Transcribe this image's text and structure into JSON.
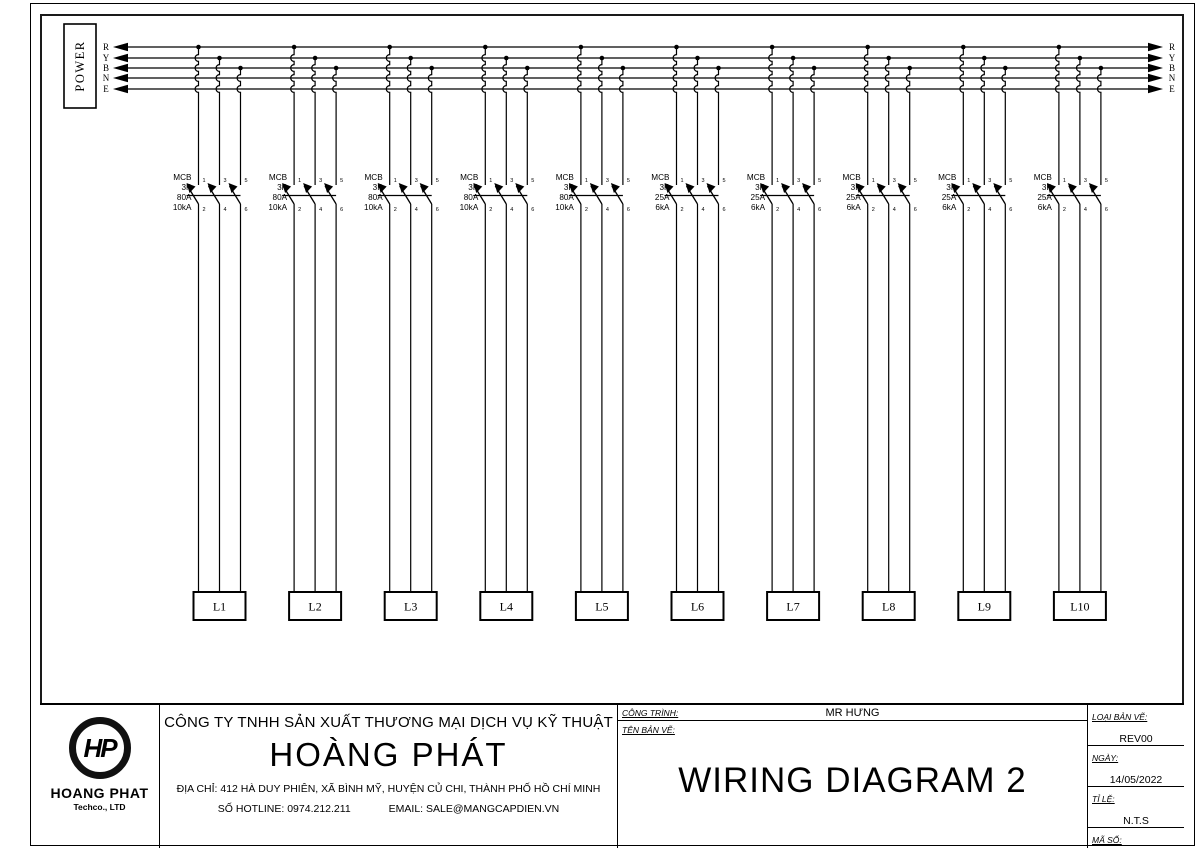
{
  "page": {
    "background": "#ffffff",
    "line_color": "#000000"
  },
  "diagram": {
    "power_label": "POWER",
    "bus_labels": [
      "R",
      "Y",
      "B",
      "N",
      "E"
    ],
    "terminal_numbers": {
      "top": [
        "1",
        "3",
        "5"
      ],
      "bottom": [
        "2",
        "4",
        "6"
      ]
    },
    "breakers": [
      {
        "load": "L1",
        "lines": [
          "MCB",
          "3P",
          "80A",
          "10kA"
        ]
      },
      {
        "load": "L2",
        "lines": [
          "MCB",
          "3P",
          "80A",
          "10kA"
        ]
      },
      {
        "load": "L3",
        "lines": [
          "MCB",
          "3P",
          "80A",
          "10kA"
        ]
      },
      {
        "load": "L4",
        "lines": [
          "MCB",
          "3P",
          "80A",
          "10kA"
        ]
      },
      {
        "load": "L5",
        "lines": [
          "MCB",
          "3P",
          "80A",
          "10kA"
        ]
      },
      {
        "load": "L6",
        "lines": [
          "MCB",
          "3P",
          "25A",
          "6kA"
        ]
      },
      {
        "load": "L7",
        "lines": [
          "MCB",
          "3P",
          "25A",
          "6kA"
        ]
      },
      {
        "load": "L8",
        "lines": [
          "MCB",
          "3P",
          "25A",
          "6kA"
        ]
      },
      {
        "load": "L9",
        "lines": [
          "MCB",
          "3P",
          "25A",
          "6kA"
        ]
      },
      {
        "load": "L10",
        "lines": [
          "MCB",
          "3P",
          "25A",
          "6kA"
        ]
      }
    ]
  },
  "title_block": {
    "logo": {
      "monogram": "HP",
      "name": "HOANG PHAT",
      "subtitle": "Techco., LTD"
    },
    "company": {
      "line1": "CÔNG TY TNHH SẢN XUẤT THƯƠNG MẠI DỊCH VỤ KỸ THUẬT",
      "name": "HOÀNG PHÁT",
      "address": "ĐỊA CHỈ: 412 HÀ DUY PHIÊN, XÃ BÌNH MỸ, HUYỆN CỦ CHI, THÀNH PHỐ HỒ CHÍ MINH",
      "hotline": "SỐ HOTLINE: 0974.212.211",
      "email": "EMAIL: SALE@MANGCAPDIEN.VN"
    },
    "drawing": {
      "project_label": "CÔNG TRÌNH:",
      "project_value": "MR HƯNG",
      "name_label": "TÊN BẢN VẼ:",
      "title": "WIRING DIAGRAM 2"
    },
    "meta": [
      {
        "label": "LOẠI BẢN VẼ:",
        "value": "REV00"
      },
      {
        "label": "NGÀY:",
        "value": "14/05/2022"
      },
      {
        "label": "TỈ LỆ:",
        "value": "N.T.S"
      },
      {
        "label": "MÃ SỐ:",
        "value": "005"
      }
    ]
  }
}
